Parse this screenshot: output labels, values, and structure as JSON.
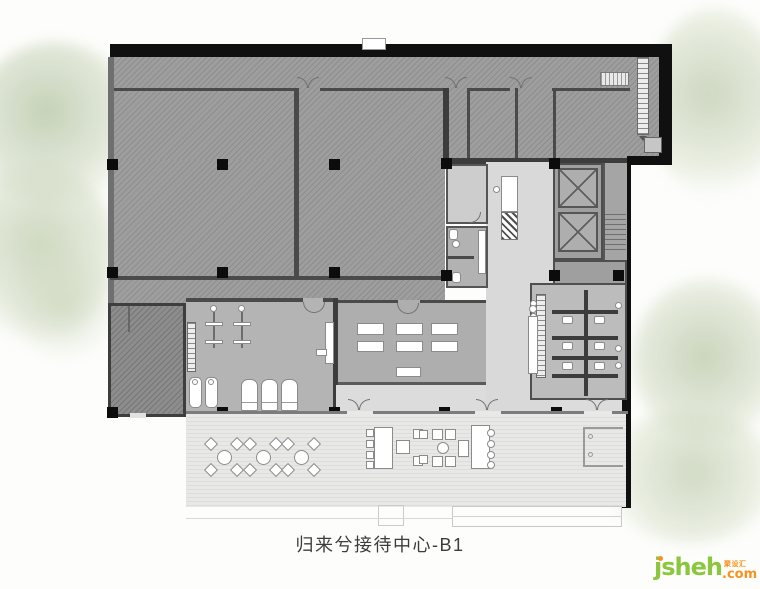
{
  "title": "归来兮接待中心-B1",
  "watermark": {
    "brand": "jsheh",
    "suffix": ".com",
    "chinese": "聚设汇"
  },
  "colors": {
    "hatched_room": "#9e9e9e",
    "dark_room": "#8d8d8d",
    "gym_floor": "#b4b4b4",
    "dining_floor": "#aeaeae",
    "lobby_floor": "#d9d9d9",
    "terrace_floor": "#e3e3e2",
    "structural_wall": "#101010",
    "title_text": "#3d3d3d",
    "logo_green": "#8cc63f",
    "logo_orange": "#f6921e"
  }
}
